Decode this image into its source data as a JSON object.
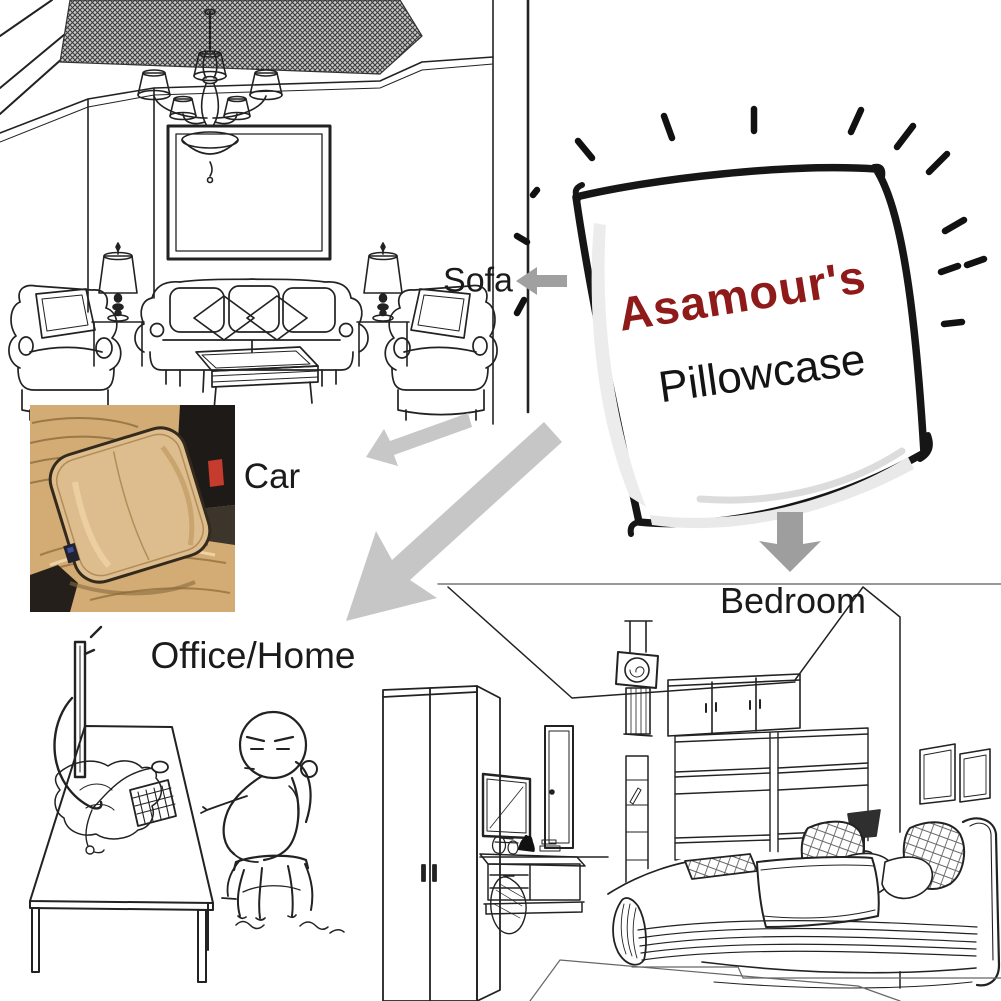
{
  "pillow": {
    "brand": "Asamour's",
    "product": "Pillowcase",
    "brand_color": "#8e1a1a",
    "product_color": "#141414",
    "outline_color": "#161616"
  },
  "labels": {
    "sofa": "Sofa",
    "car": "Car",
    "office": "Office/Home",
    "bedroom": "Bedroom",
    "color": "#1b1b1b"
  },
  "arrows": {
    "sofa": "#a0a0a0",
    "car": "#c7c7c7",
    "office": "#c6c6c6",
    "bedroom": "#9e9e9e"
  },
  "car_photo": {
    "seat": "#d3ab74",
    "seat_shadow": "#9a7847",
    "pillow": "#ddbd8d",
    "dark": "#1d1a17",
    "floor_dark": "#241f1b",
    "buckle": "#c53b2e"
  },
  "drawing": {
    "ink": "#222222"
  }
}
